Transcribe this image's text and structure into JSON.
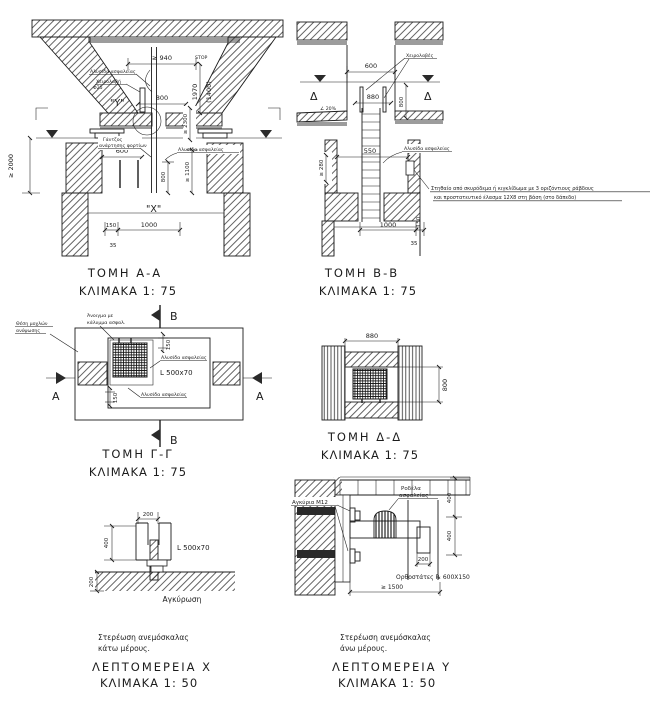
{
  "colors": {
    "ink": "#1c1c1c",
    "paper": "#ffffff",
    "shadow": "#9c9c9c"
  },
  "aa": {
    "title": "ΤΟΜΗ  Α-Α",
    "scale": "ΚΛΙΜΑΚΑ  1: 75",
    "chain_top": "Αλυσίδα ασφαλείας",
    "handle1": "Χειρολαβή",
    "handle2": "Φ25",
    "mark_y": "\"Υ\"",
    "stop": "STOP",
    "d940": "≥ 940",
    "d800a": "800",
    "d1970": "1970",
    "d1400": "(1400)",
    "d2300": "≥ 2300",
    "d2000": "≥ 2000",
    "d600": "600",
    "hook1": "Γάντζος",
    "hook2": "ανάρτησης φορτίων",
    "chain_bottom": "Αλυσίδα ασφαλείας",
    "d800b": "800",
    "d1100": "≥ 1100",
    "mark_x": "\"Χ\"",
    "d150": "150",
    "d1000": "1000",
    "d35": "35"
  },
  "bb": {
    "title": "ΤΟΜΗ  Β-Β",
    "scale": "ΚΛΙΜΑΚΑ  1: 75",
    "handles": "Χειρολαβές",
    "d600": "600",
    "delta_left": "Δ",
    "delta_right": "Δ",
    "d880": "880",
    "d800": "800",
    "slope": "∠ 20%",
    "d550": "550",
    "d280": "≥ 280",
    "chain": "Αλυσίδα ασφαλείας",
    "note1": "Στηθαίο από σκυρόδεμα ή κιγκλίδωμα με 3 οριζόντιους ράβδους",
    "note2": "και προστατευτικό έλασμα 12Χ8 στη βάση (στο δάπεδο)",
    "d1000": "1000",
    "d150": "150",
    "d35": "35"
  },
  "gg": {
    "title": "ΤΟΜΗ  Γ-Γ",
    "scale": "ΚΛΙΜΑΚΑ  1: 75",
    "levers1": "Θέση μοχλών",
    "levers2": "ανύψωσης",
    "opening1": "Άνοιγμα με",
    "opening2": "κάλυμμα ασφαλ.",
    "mark_b_top": "Β",
    "mark_b_bottom": "Β",
    "mark_a_left": "Α",
    "mark_a_right": "Α",
    "d150a": "150",
    "d150b": "150",
    "angle": "L  500x70",
    "chain1": "Αλυσίδα ασφαλείας",
    "chain2": "Αλυσίδα ασφαλείας"
  },
  "dd": {
    "title": "ΤΟΜΗ  Δ-Δ",
    "scale": "ΚΛΙΜΑΚΑ  1: 75",
    "d880": "880",
    "d800": "800"
  },
  "dx": {
    "d200a": "200",
    "d400": "400",
    "d200b": "200",
    "angle": "L  500x70",
    "anchor": "Αγκύρωση",
    "caption1": "Στερέωση ανεμόσκαλας",
    "caption2": "κάτω μέρους.",
    "title": "ΛΕΠΤΟΜΕΡΕΙΑ  Χ",
    "scale": "ΚΛΙΜΑΚΑ  1: 50"
  },
  "dy": {
    "anchors": "Αγκύρια Μ12",
    "washer1": "Ροδέλα",
    "washer2": "ασφαλείας",
    "d400a": "400",
    "d400b": "400",
    "d200": "200",
    "posts": "Ορθοστάτες ℞ 600X150",
    "d1500": "≥ 1500",
    "caption1": "Στερέωση ανεμόσκαλας",
    "caption2": "άνω μέρους.",
    "title": "ΛΕΠΤΟΜΕΡΕΙΑ  Υ",
    "scale": "ΚΛΙΜΑΚΑ  1: 50"
  }
}
